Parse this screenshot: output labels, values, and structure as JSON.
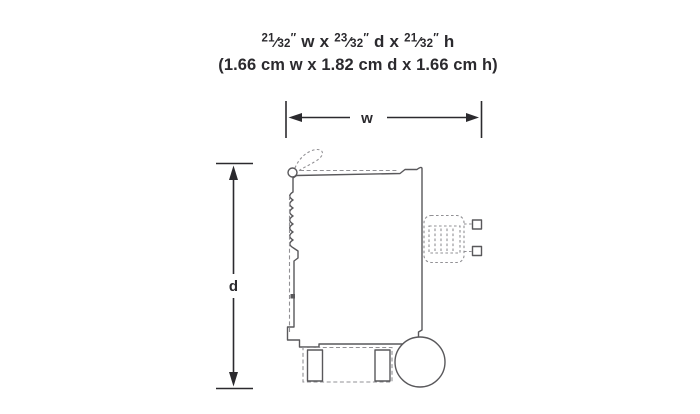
{
  "header": {
    "frac_slash": "⁄",
    "line1": {
      "f1_num": "21",
      "f1_den": "32",
      "q1": "″",
      "mid1": " w x ",
      "f2_num": "23",
      "f2_den": "32",
      "q2": "″",
      "mid2": " d x ",
      "f3_num": "21",
      "f3_den": "32",
      "q3": "″",
      "end": " h"
    },
    "line2": "(1.66 cm w x 1.82 cm d x 1.66 cm h)"
  },
  "dimensions": {
    "width_label": "w",
    "depth_label": "d"
  },
  "colors": {
    "ink": "#2b2a2e",
    "line": "#59585b",
    "dash": "#919094",
    "bg": "#ffffff"
  }
}
